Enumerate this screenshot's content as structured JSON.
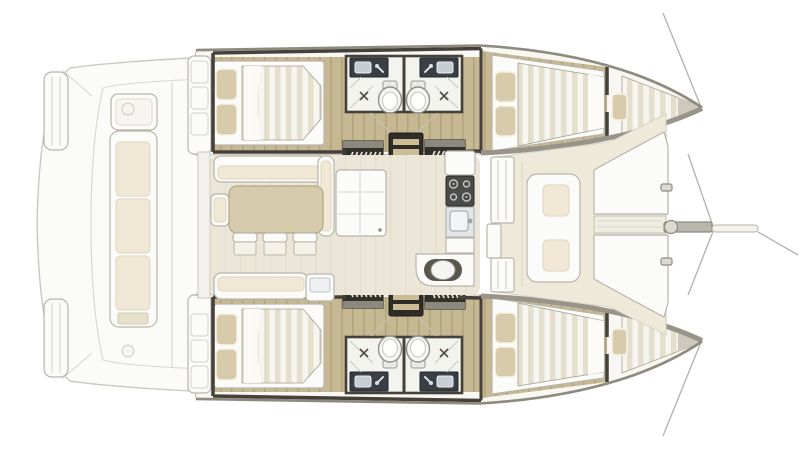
{
  "meta": {
    "label": "catamaran-interior-floor-plan",
    "view": "top-down deck plan, bow pointing right, stern left",
    "background": "#ffffff"
  },
  "palette": {
    "bg": "#ffffff",
    "hull-edge": "#8e8a7d",
    "deck-band": "#98948a",
    "wall-dark": "#45413a",
    "wood": "#c6b892",
    "wood-stripe": "#b2a37b",
    "mattress": "#f7f5ef",
    "mattress-stripe": "#e4decd",
    "pillow": "#d8cbab",
    "cushion": "#f0e8d4",
    "saloon-floor": "#ece6d8",
    "saloon-floor-stripe": "#e4ddcb",
    "table": "#d7cbae",
    "white-furniture": "#fbfbf9",
    "furniture-line": "#b9b5aa",
    "stair-dark": "#32302a",
    "stair-rung": "#e8e4d6",
    "counter-dark": "#3a3f46",
    "stove": "#4b4b49",
    "burner": "#c3c6c8",
    "porcelain": "#f5f5f3",
    "porcelain-line": "#8e8e88",
    "shower-mark": "#55514a",
    "rig-line": "#b3b1ab",
    "beam-fill": "#b9b6ad",
    "fwd-floor": "#efe9d9"
  },
  "inventory": {
    "hulls": [
      {
        "name": "port-hull",
        "aft-cabin": {
          "double-bed": 1,
          "pillows": 2
        },
        "forward-cabin": {
          "double-bed": 1,
          "pillows": 2
        },
        "forepeak-berth": {
          "berth": 1,
          "cushions": 1
        },
        "bathrooms": 2,
        "washbasins": 2,
        "toilets": 2,
        "showers": 2,
        "companionway-step-units": 2,
        "ladder": 1
      },
      {
        "name": "starboard-hull",
        "aft-cabin": {
          "double-bed": 1,
          "pillows": 2
        },
        "forward-cabin": {
          "double-bed": 1,
          "pillows": 2
        },
        "forepeak-berth": {
          "berth": 1,
          "cushions": 1
        },
        "bathrooms": 2,
        "washbasins": 2,
        "toilets": 2,
        "showers": 2,
        "companionway-step-units": 2,
        "ladder": 1
      }
    ],
    "saloon": {
      "sofa": "L-shaped",
      "dining-table": 1,
      "stools": 3,
      "aft-bench": 1,
      "side-seat": 1,
      "sideboard": 1
    },
    "galley": {
      "stove-burners": 4,
      "rectangular-sink": 1,
      "round-sink": 1,
      "counters": 3
    },
    "aft-cockpit": {
      "bench-seats": 1,
      "bench-cushions": 3,
      "deck-hatches": 2,
      "transom-step-platforms": 2
    },
    "forward-cockpit": {
      "seat-cushions": 2,
      "foredeck-sunpads": 2
    },
    "bow": {
      "crossbeam": 1,
      "bowsprit": 1,
      "forestay-lines": 2,
      "pulpit-lines": 2
    }
  }
}
